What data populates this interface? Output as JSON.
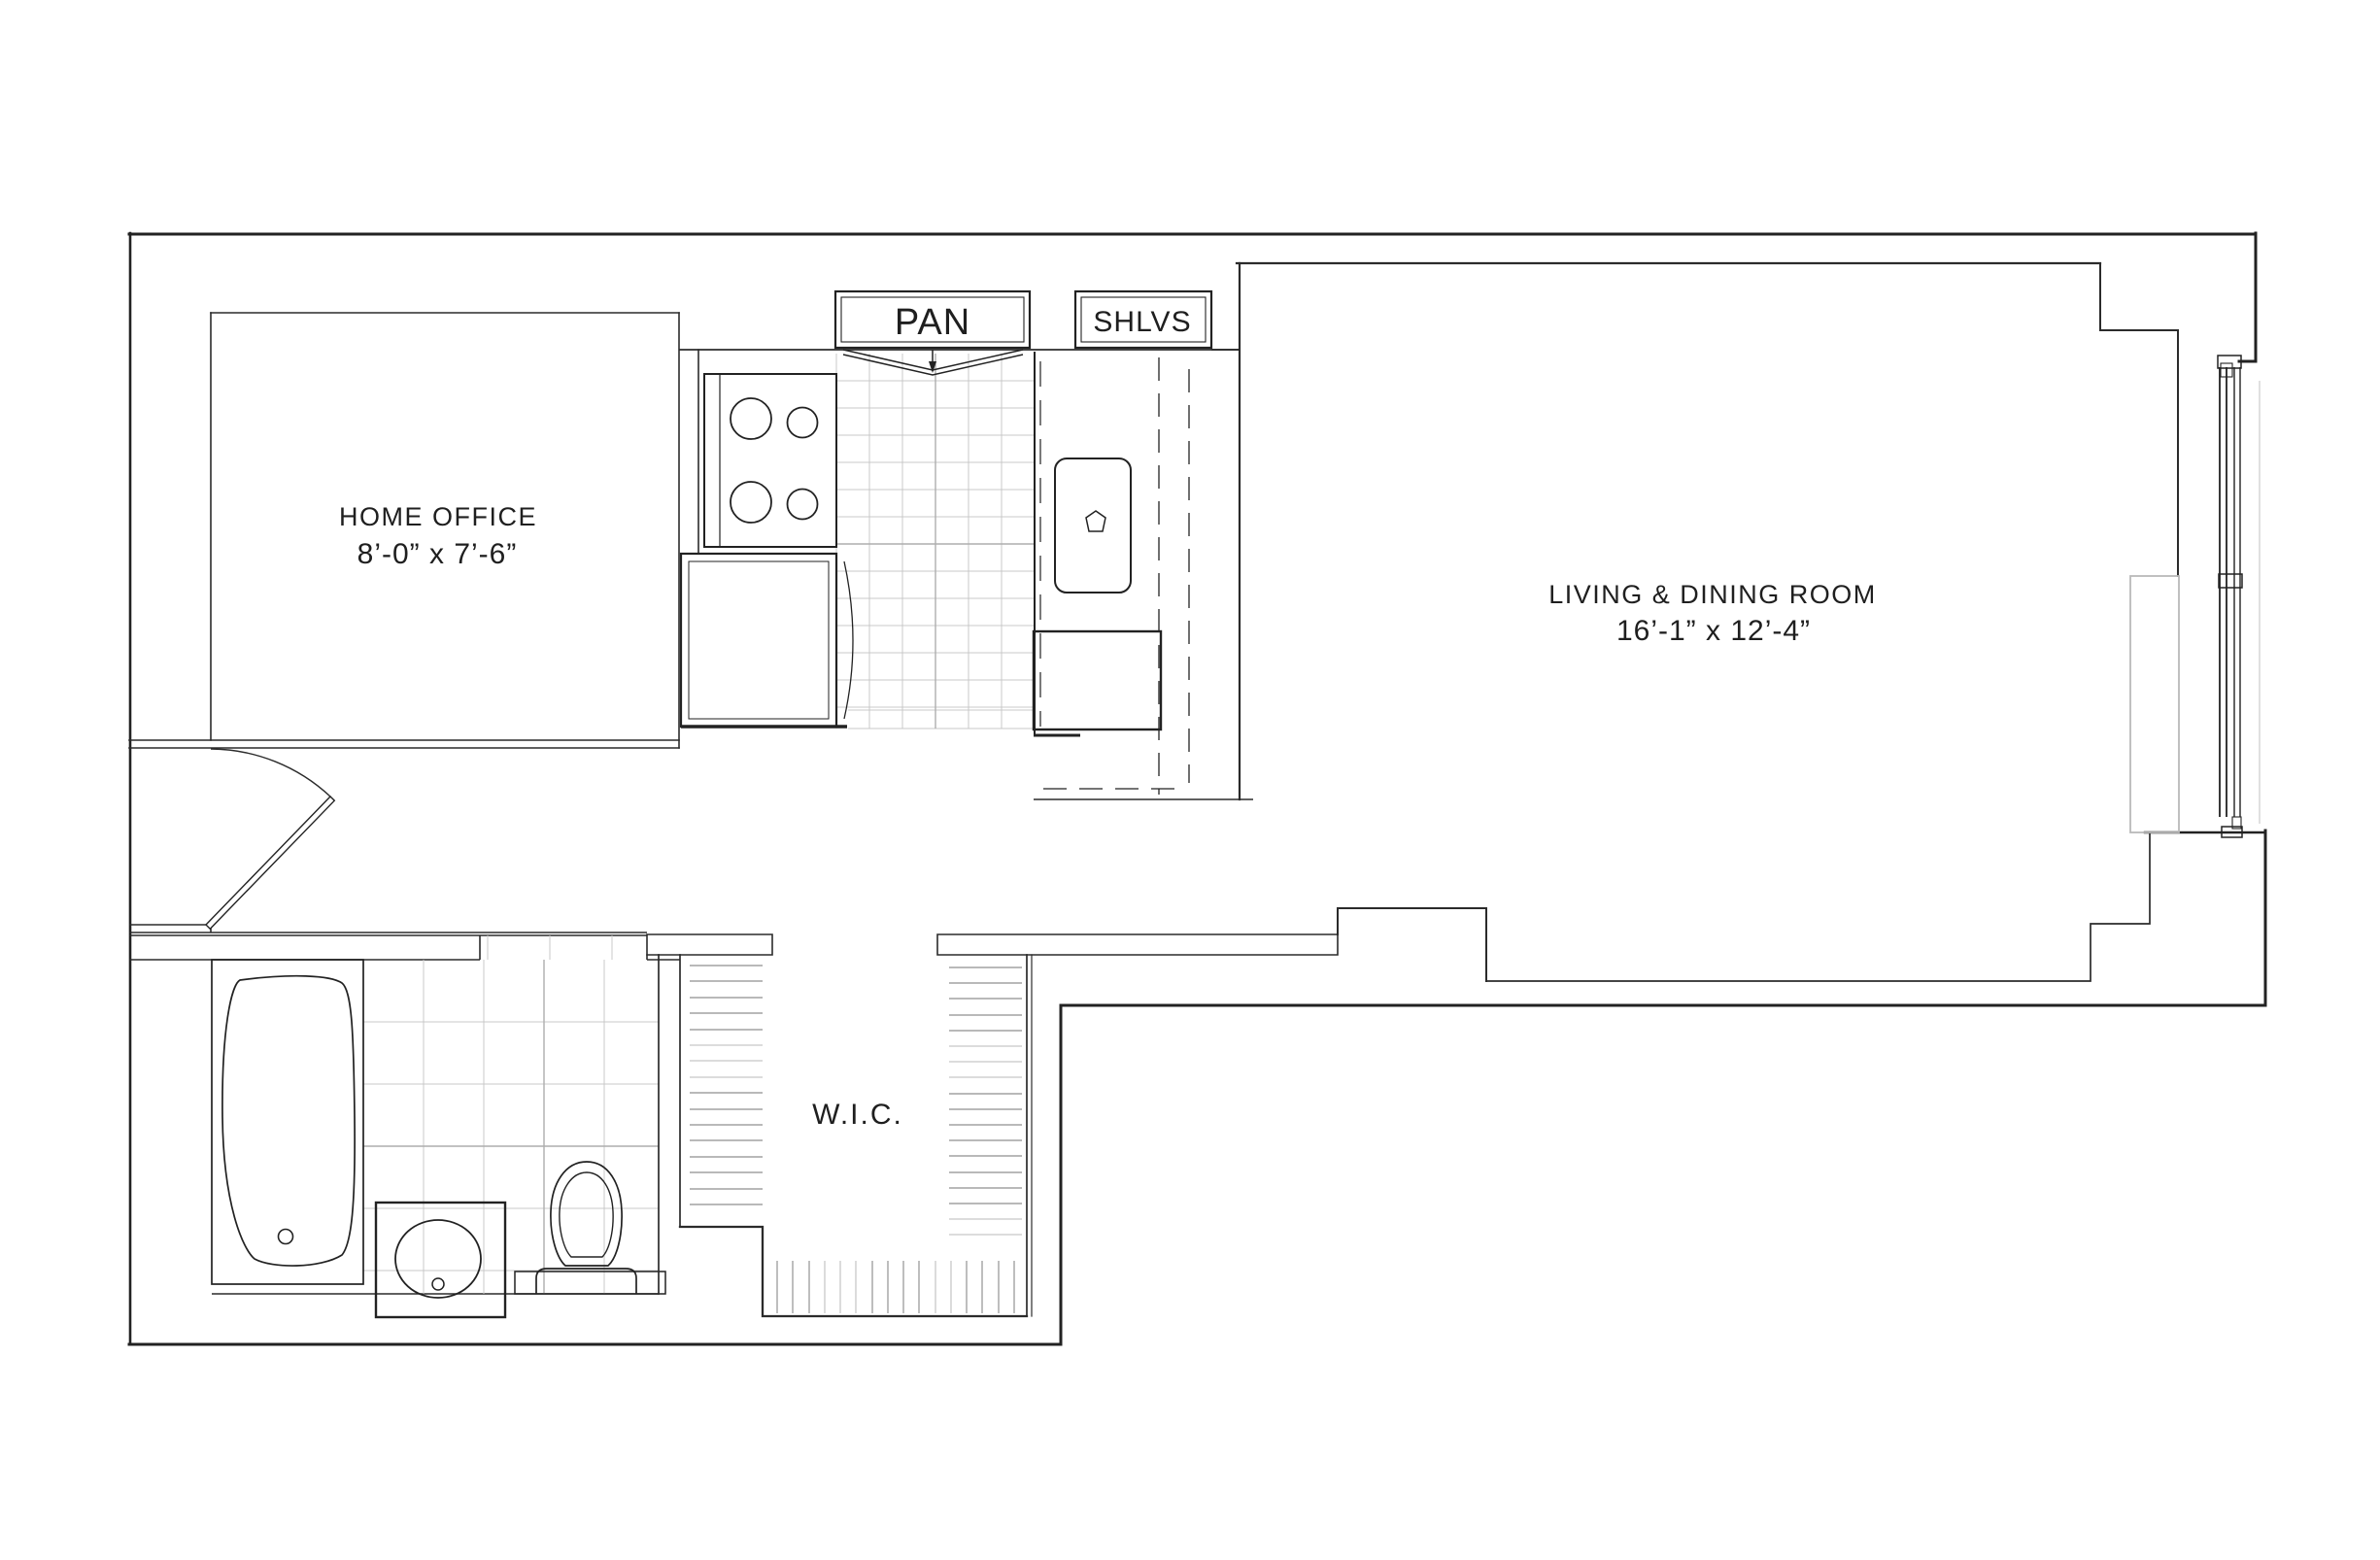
{
  "plan": {
    "rooms": {
      "home_office": {
        "name": "HOME OFFICE",
        "dims": "8’-0” x 7’-6”"
      },
      "living_dining": {
        "name": "LIVING & DINING ROOM",
        "dims": "16’-1” x 12’-4”"
      },
      "walk_in_closet": {
        "name": "W.I.C."
      },
      "pantry": {
        "name": "PAN"
      },
      "shelves": {
        "name": "SHLVS"
      }
    },
    "fixtures": [
      "stove-4-burner",
      "kitchen-sink",
      "kitchen-counter",
      "base-cabinet",
      "bathtub",
      "vanity-sink",
      "toilet",
      "entry-door-swing",
      "pantry-bifold-door",
      "window-assembly",
      "radiator",
      "closet-shelving"
    ],
    "colors": {
      "wall": "#222222",
      "thin_line": "#2b2b2b",
      "tile_light": "#c9c9c9",
      "tile_medium": "#aeaeae",
      "shelf_dark": "#8f8f8f",
      "shelf_light": "#c8c8c8",
      "radiator_gray": "#b9b9b9",
      "background": "#ffffff"
    }
  }
}
